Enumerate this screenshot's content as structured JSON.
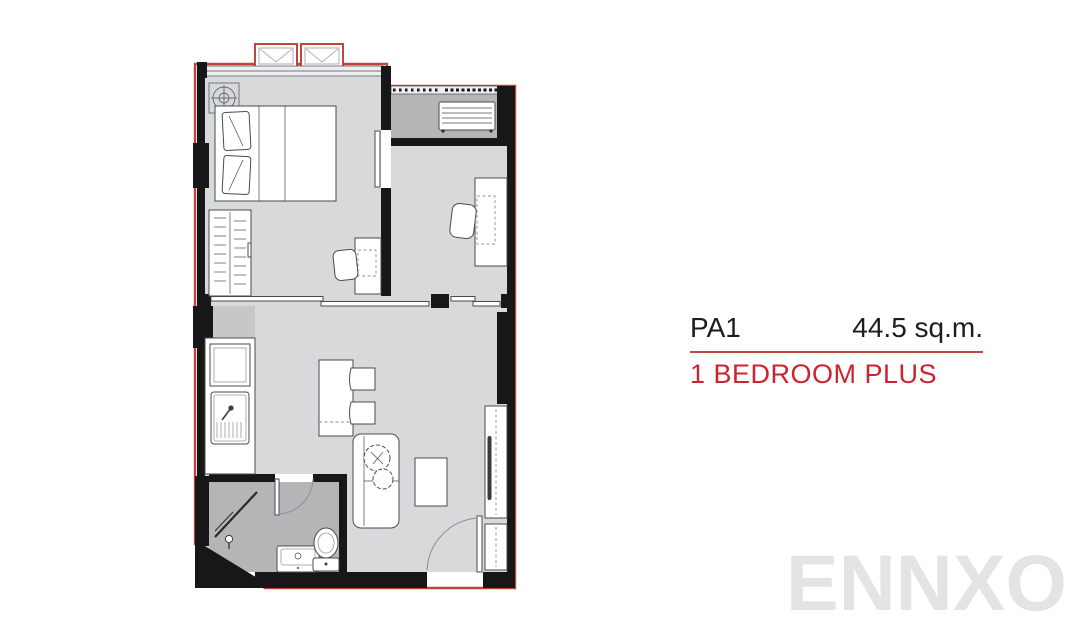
{
  "info_panel": {
    "unit_code": "PA1",
    "area": "44.5 sq.m.",
    "unit_type": "1 BEDROOM PLUS"
  },
  "watermark": {
    "text": "ENNXO"
  },
  "colors": {
    "accent_red": "#c14944",
    "outline_red": "#c2453c",
    "type_red": "#cb242f",
    "text_black": "#1d1d1f",
    "watermark_gray": "#e4e4e6",
    "wall_black": "#17171a",
    "floor_light": "#d7d9db",
    "floor_mid": "#c5c7c9",
    "floor_dark": "#b3b5b7",
    "furniture_fill": "#ffffff",
    "furniture_stroke": "#4b4b4f",
    "window_band": "#eeeef0"
  },
  "floor_plan": {
    "fixtures": [
      "ceiling-light",
      "bed",
      "pillows",
      "wardrobe",
      "vanity-desk",
      "vanity-chair",
      "ac-condenser",
      "balcony-railing",
      "study-desk",
      "study-chair",
      "sliding-doors",
      "fridge",
      "kitchen-sink",
      "dining-table",
      "dining-chairs",
      "sofa",
      "plant",
      "coffee-table",
      "tv-console",
      "tv",
      "shoe-cabinet",
      "entry-door",
      "shower",
      "bathroom-door",
      "bathroom-sink",
      "toilet"
    ]
  }
}
